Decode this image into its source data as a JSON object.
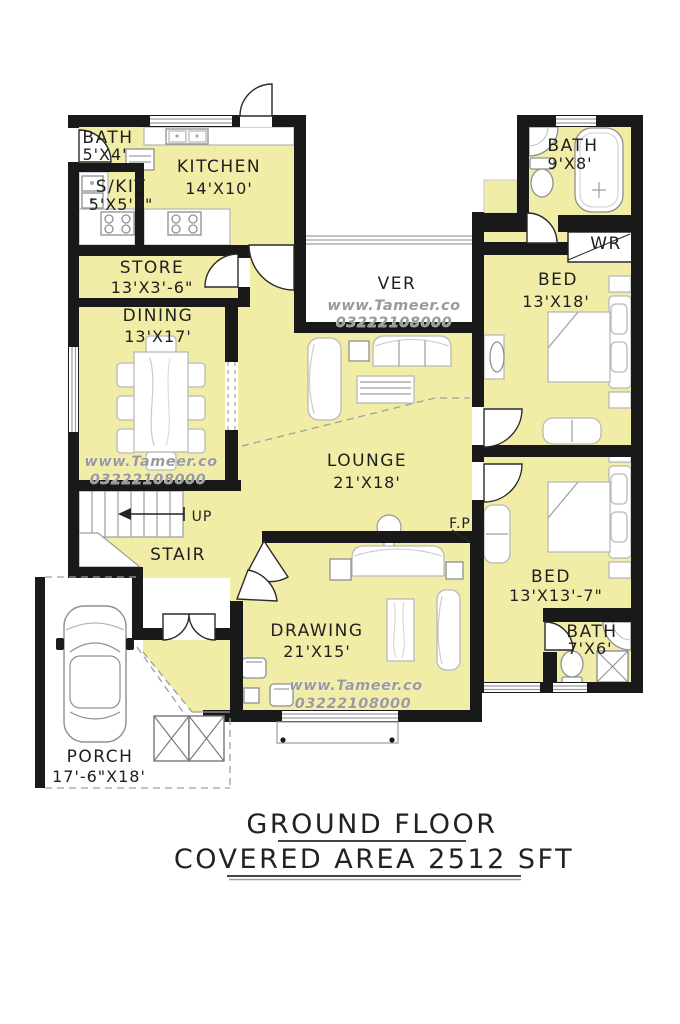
{
  "title": {
    "line1": "GROUND FLOOR",
    "line2": "COVERED AREA 2512 SFT"
  },
  "watermark": {
    "site": "www.Tameer.co",
    "phone": "03222108000"
  },
  "colors": {
    "room_fill": "#f1eca6",
    "wall": "#191919",
    "watermark_gray": "#9a9a9a"
  },
  "rooms": {
    "bath1": {
      "name": "BATH",
      "size": "5'X4'"
    },
    "skit": {
      "name": "S/KIT",
      "size": "5'X5'7\""
    },
    "kitchen": {
      "name": "KITCHEN",
      "size": "14'X10'"
    },
    "store": {
      "name": "STORE",
      "size": "13'X3'-6\""
    },
    "dining": {
      "name": "DINING",
      "size": "13'X17'"
    },
    "ver": {
      "name": "VER"
    },
    "lounge": {
      "name": "LOUNGE",
      "size": "21'X18'"
    },
    "stair": {
      "name": "STAIR",
      "up": "UP"
    },
    "drawing": {
      "name": "DRAWING",
      "size": "21'X15'"
    },
    "porch": {
      "name": "PORCH",
      "size": "17'-6\"X18'"
    },
    "bath2": {
      "name": "BATH",
      "size": "9'X8'"
    },
    "wr": {
      "name": "WR"
    },
    "bed1": {
      "name": "BED",
      "size": "13'X18'"
    },
    "bed2": {
      "name": "BED",
      "size": "13'X13'-7\""
    },
    "bath3": {
      "name": "BATH",
      "size": "7'X6'"
    },
    "fireplace": {
      "name": "F.P"
    }
  }
}
